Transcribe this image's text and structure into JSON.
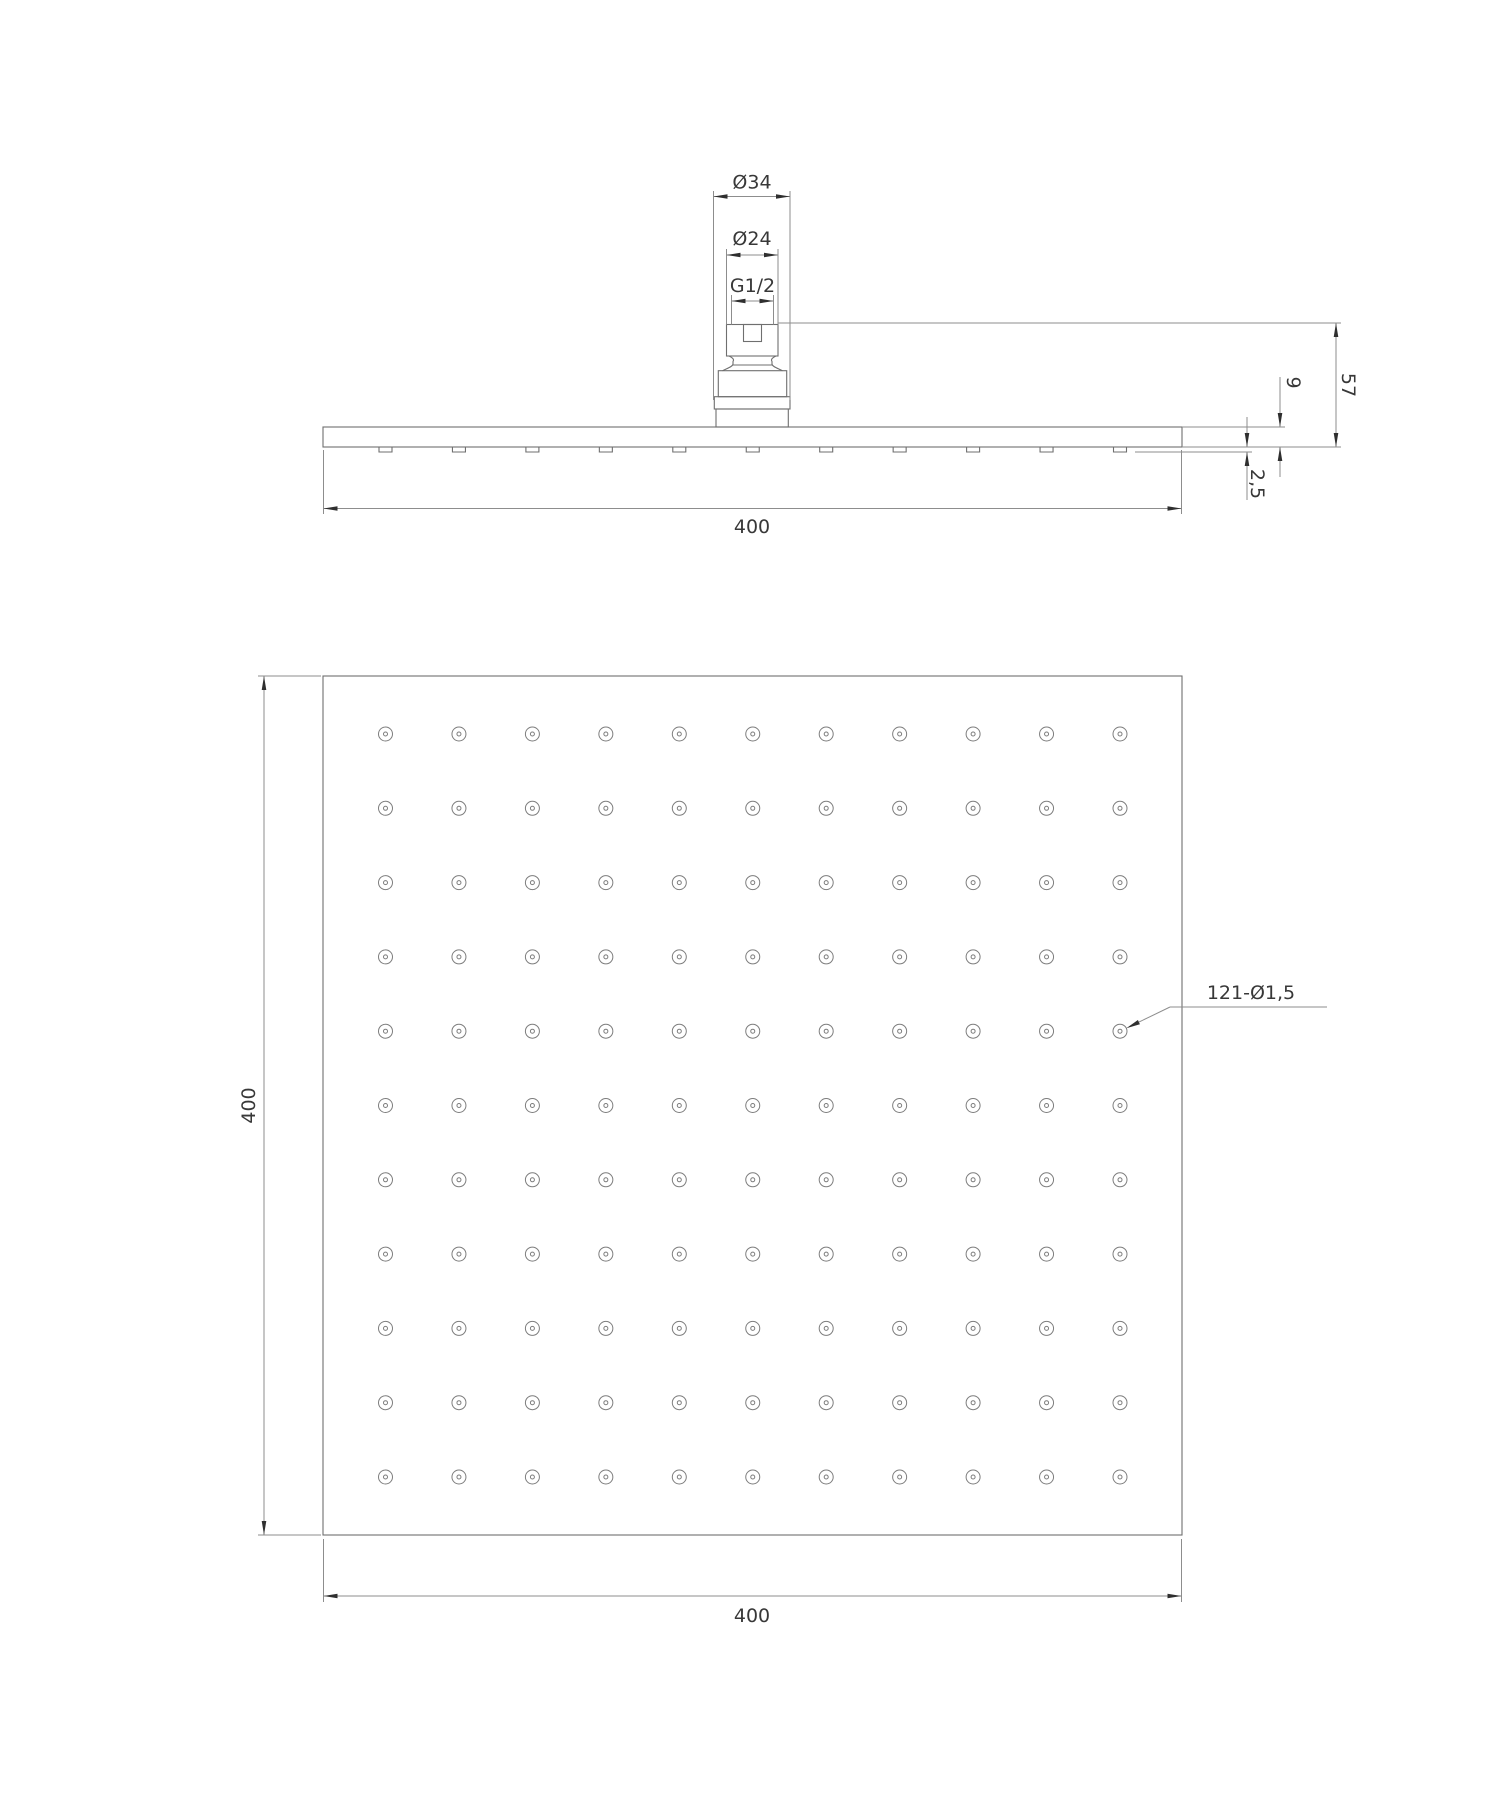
{
  "drawing": {
    "side_view": {
      "dim_diameter_outer": "Ø34",
      "dim_diameter_inner": "Ø24",
      "dim_thread": "G1/2",
      "dim_total_height": "57",
      "dim_plate_thickness": "9",
      "dim_nozzle_protrusion": "2,5",
      "dim_width": "400",
      "nozzle_count": 11
    },
    "face_view": {
      "dim_height": "400",
      "dim_width": "400",
      "holes_note": "121-Ø1,5",
      "hole_rows": 11,
      "hole_cols": 11,
      "hole_count": 121
    },
    "geometry": {
      "hole_grid": {
        "x0": 385.5,
        "y0": 734,
        "dx": 73.45,
        "dy": 74.3,
        "outer_r": 7,
        "inner_r": 2
      },
      "nozzle_row": {
        "x0": 385.5,
        "dx": 73.45,
        "width": 13,
        "top": 447,
        "bottom": 452
      }
    },
    "colors": {
      "object_line": "#6f6f6f",
      "dimension_line": "#8d8d8d",
      "text": "#383838",
      "arrow": "#2f2f2f",
      "background": "#ffffff"
    }
  }
}
